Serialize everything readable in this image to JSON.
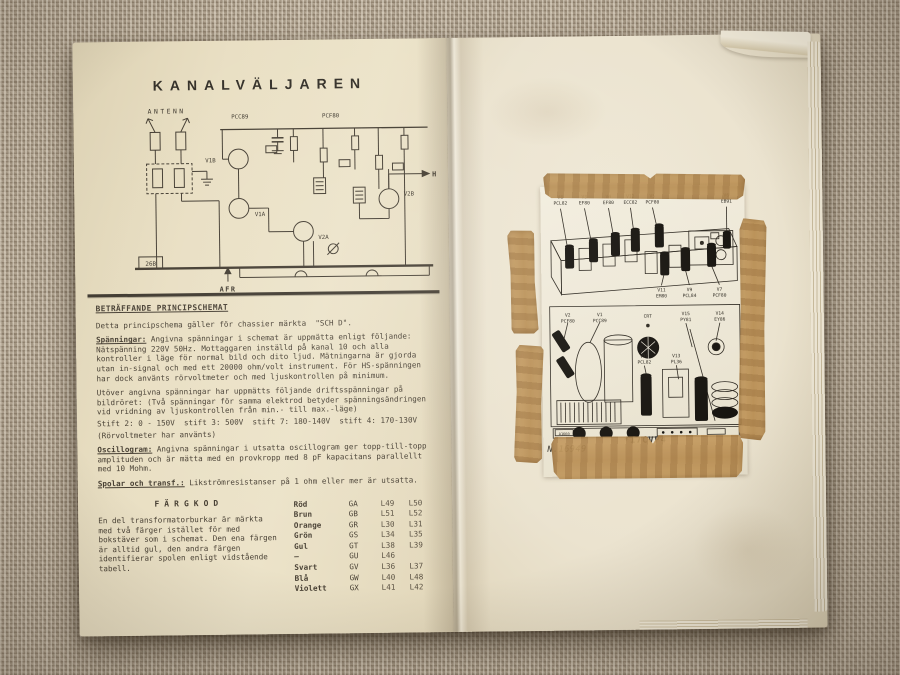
{
  "booklet": {
    "left_page": {
      "title": "KANALVÄLJAREN",
      "schematic": {
        "antenn": "ANTENN",
        "tube_top_left": "PCC89",
        "tube_top_right": "PCF80",
        "v1b": "V1B",
        "v1a": "V1A",
        "v2a": "V2A",
        "v2b": "V2B",
        "hf": "HF",
        "afr": "AFR",
        "ref_box": "26B"
      },
      "notes": {
        "heading": "BETRÄFFANDE PRINCIPSCHEMAT",
        "intro": "Detta principschema gäller för chassier märkta  \"SCH D\".",
        "spanningar_label": "Spänningar:",
        "spanningar_text": " Angivna spänningar i schemat är uppmätta enligt följande: Nätspänning 220V 50Hz. Mottaggaren inställd på kanal 10 och alla kontroller i läge för normal bild och dito ljud. Mätningarna är gjorda utan in-signal och med ett 20000 ohm/volt instrument. För HS-spänningen har dock använts rörvoltmeter och med ljuskontrollen på minimum.",
        "utover_text": "Utöver angivna spänningar har uppmätts följande driftsspänningar på bildröret: (Två spänningar för samma elektrod betyder spänningsändringen vid vridning av ljuskontrollen från min.- till max.-läge)",
        "stift_line": "Stift 2: 0 - 150V  stift 3: 500V  stift 7: 180-140V  stift 4: 170-130V",
        "rorvoltmeter_line": "(Rörvoltmeter har använts)",
        "oscillogram_label": "Oscillogram:",
        "oscillogram_text": " Angivna spänningar i utsatta oscillogram ger topp-till-topp amplituden och är mätta med en provkropp med 8 pF kapacitans parallellt med 10 Mohm.",
        "spolar_label": "Spolar och transf.:",
        "spolar_text": " Likströmresistanser på 1 ohm eller mer är utsatta."
      },
      "fargkod": {
        "heading": "FÄRGKOD",
        "note": "En del transformatorburkar är märkta med två färger istället för med bokstäver som i schemat. Den ena färgen är alltid gul, den andra färgen identifierar spolen enligt vidstående tabell.",
        "rows": [
          {
            "color": "Röd",
            "code": "GA",
            "l1": "L49",
            "l2": "L50"
          },
          {
            "color": "Brun",
            "code": "GB",
            "l1": "L51",
            "l2": "L52"
          },
          {
            "color": "Orange",
            "code": "GR",
            "l1": "L30",
            "l2": "L31"
          },
          {
            "color": "Grön",
            "code": "GS",
            "l1": "L34",
            "l2": "L35"
          },
          {
            "color": "Gul",
            "code": "GT",
            "l1": "L38",
            "l2": "L39"
          },
          {
            "color": "—",
            "code": "GU",
            "l1": "L46",
            "l2": ""
          },
          {
            "color": "Svart",
            "code": "GV",
            "l1": "L36",
            "l2": "L37"
          },
          {
            "color": "Blå",
            "code": "GW",
            "l1": "L40",
            "l2": "L48"
          },
          {
            "color": "Violett",
            "code": "GX",
            "l1": "L41",
            "l2": "L42"
          }
        ]
      }
    },
    "right_page": {
      "diagram": {
        "tubes_top": [
          {
            "v": "V8",
            "t": "PCL82"
          },
          {
            "v": "V3",
            "t": "EF80"
          },
          {
            "v": "V4",
            "t": "EF80"
          },
          {
            "v": "V12",
            "t": "ECC82"
          },
          {
            "v": "V5",
            "t": "PCF80"
          },
          {
            "v": "V6",
            "t": "EB91"
          }
        ],
        "tubes_mid": [
          {
            "v": "V11",
            "t": "EM80"
          },
          {
            "v": "V9",
            "t": "PCL84"
          },
          {
            "v": "V7",
            "t": "PCF80"
          }
        ],
        "tubes_lower": [
          {
            "v": "V2",
            "t": "PCF80"
          },
          {
            "v": "V1",
            "t": "PCC89"
          },
          {
            "v": "CRT",
            "t": ""
          },
          {
            "v": "V15",
            "t": "PY81"
          },
          {
            "v": "V14",
            "t": "EY86"
          }
        ],
        "tubes_low2": [
          {
            "v": "V10",
            "t": "PCL82"
          },
          {
            "v": "V13",
            "t": "PL36"
          }
        ],
        "panel_code": "A1660",
        "serial": "N.16949",
        "crt_type": "*17CVP4"
      }
    }
  }
}
